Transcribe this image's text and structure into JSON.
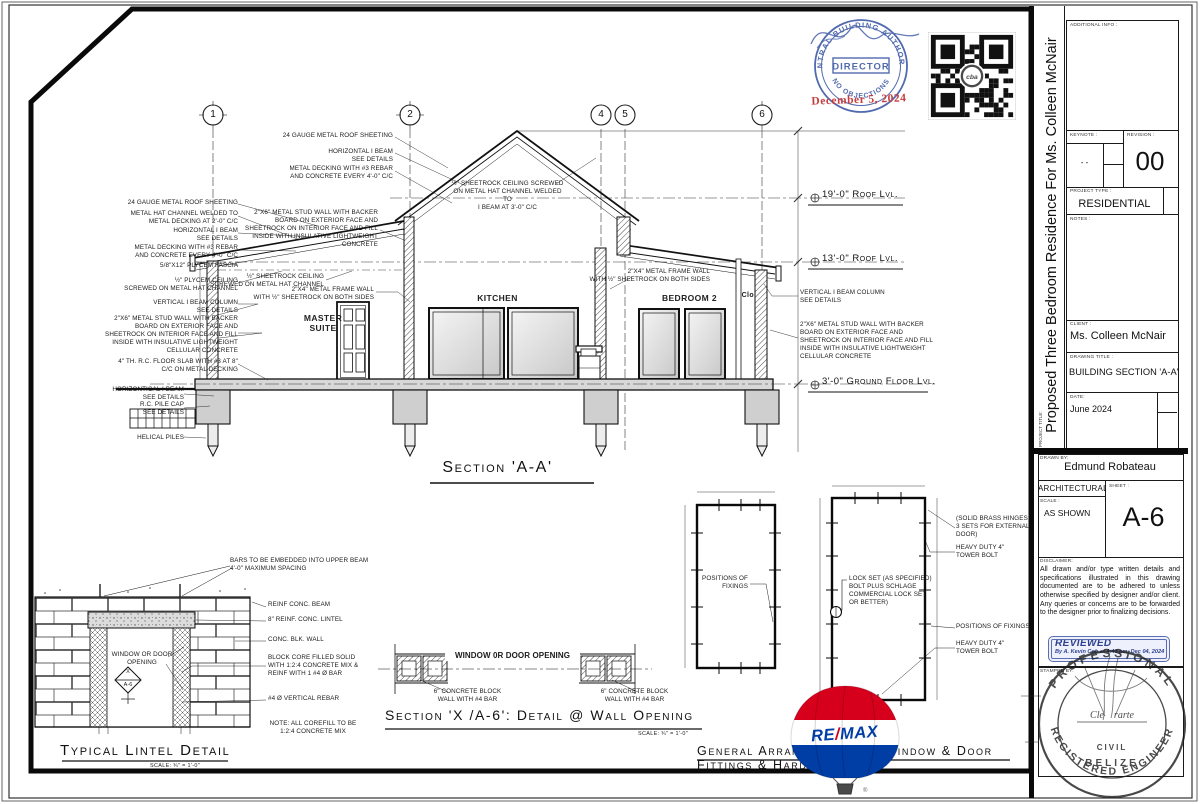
{
  "section": {
    "title": "Section 'A-A'",
    "grids": [
      "1",
      "2",
      "4",
      "5",
      "6"
    ],
    "levels": {
      "roof19": "19'-0\" Roof Lvl.",
      "roof13": "13'-0\" Roof Lvl.",
      "ground": "3'-0\" Ground Floor Lvl."
    },
    "rooms": {
      "master": [
        "MASTER",
        "SUITE"
      ],
      "kitchen": "KITCHEN",
      "bedroom2": "BEDROOM 2",
      "closet": "Clo."
    },
    "ann_left": [
      [
        "24 GAUGE METAL ROOF SHEETING"
      ],
      [
        "METAL HAT CHANNEL WELDED TO",
        "METAL DECKING AT 2'-0\" C/C"
      ],
      [
        "HORIZONTAL I BEAM",
        "SEE DETAILS"
      ],
      [
        "METAL DECKING WITH #3 REBAR",
        "AND CONCRETE EVERY 4'-0\" C/C"
      ],
      [
        "5/8\"X12\" PLYCEM FASCIA"
      ],
      [
        "½\" PLYCEM CEILING",
        "SCREWED ON METAL HAT CHANNEL"
      ],
      [
        "VERTICAL I BEAM COLUMN",
        "SEE DETAILS"
      ],
      [
        "2\"X6\" METAL STUD WALL WITH BACKER",
        "BOARD ON EXTERIOR FACE AND",
        "SHEETROCK ON INTERIOR FACE AND FILL",
        "INSIDE WITH INSULATIVE LIGHTWEIGHT",
        "CELLULAR CONCRETE"
      ],
      [
        "4\" TH. R.C. FLOOR SLAB WITH #3 AT 8\"",
        "C/C ON METAL DECKING"
      ],
      [
        "HORIZONTICAL I BEAM",
        "SEE DETAILS"
      ],
      [
        "R.C.  PILE CAP",
        "SEE DETAILS"
      ],
      [
        "HELICAL PILES"
      ]
    ],
    "ann_top": [
      [
        "24 GAUGE METAL ROOF SHEETING"
      ],
      [
        "HORIZONTAL I BEAM",
        "SEE DETAILS"
      ],
      [
        "METAL DECKING WITH #3 REBAR",
        "AND CONCRETE EVERY 4'-0\" C/C"
      ],
      [
        "2\"X6\" METAL STUD WALL WITH BACKER",
        "BOARD ON EXTERIOR FACE AND",
        "SHEETROCK ON INTERIOR FACE AND FILL",
        "INSIDE WITH INSULATIVE LIGHTWEIGHT",
        "CONCRETE"
      ]
    ],
    "ridge_ceiling": [
      "½\" SHEETROCK CEILING SCREWED",
      "ON METAL HAT CHANNEL WELDED TO",
      "I BEAM AT 3'-0\" C/C"
    ],
    "master_ceiling": [
      "½\" SHEETROCK CEILING",
      "SCREWED ON METAL HAT CHANNEL"
    ],
    "frame_wall_left": [
      "2\"X4\" METAL FRAME WALL",
      "WITH ½\" SHEETROCK ON BOTH SIDES"
    ],
    "frame_wall_right": [
      "2\"X4\" METAL FRAME WALL",
      "WITH ½\" SHEETROCK ON BOTH SIDES"
    ],
    "ann_right": [
      [
        "VERTICAL I BEAM COLUMN",
        "SEE DETAILS"
      ],
      [
        "2\"X6\" METAL STUD WALL WITH BACKER",
        "BOARD ON EXTERIOR FACE AND",
        "SHEETROCK ON INTERIOR FACE AND FILL",
        "INSIDE WITH INSULATIVE LIGHTWEIGHT",
        "CELLULAR CONCRETE"
      ]
    ]
  },
  "lintel": {
    "ann": [
      [
        "BARS TO BE EMBEDDED INTO UPPER BEAM",
        "4'-0\" MAXIMUM SPACING"
      ],
      [
        "REINF CONC. BEAM"
      ],
      [
        "8\" REINF. CONC.  LINTEL"
      ],
      [
        "CONC. BLK. WALL"
      ],
      [
        "BLOCK CORE FILLED SOLID",
        "WITH 1:2:4 CONCRETE MIX &",
        "REINF WITH 1 #4 Ø BAR"
      ],
      [
        "#4 Ø VERTICAL REBAR"
      ],
      [
        "NOTE: ALL COREFILL TO BE",
        "1:2:4 CONCRETE MIX"
      ]
    ],
    "opening": [
      "WINDOW OR DOOR",
      "OPENING"
    ],
    "marker_top": "X",
    "marker_bottom": "A-6",
    "title": "Typical Lintel Detail",
    "scale": "SCALE: ¾\" = 1'-0\""
  },
  "wallopen": {
    "opening": "WINDOW 0R DOOR OPENING",
    "block_left": [
      "6\" CONCRETE BLOCK",
      "WALL WITH #4 BAR"
    ],
    "block_right": [
      "6\" CONCRETE BLOCK",
      "WALL WITH #4 BAR"
    ],
    "title": "Section 'X /A-6': Detail @ Wall Opening",
    "scale": "SCALE: ¾\" = 1'-0\""
  },
  "hardware": {
    "fixings_window": [
      "POSITIONS OF",
      "FIXINGS"
    ],
    "hinges": [
      "(SOLID BRASS HINGES",
      "3 SETS FOR EXTERNAL",
      "DOOR)"
    ],
    "bolt_top": [
      "HEAVY DUTY 4\"",
      "TOWER BOLT"
    ],
    "lockset": [
      "LOCK SET (AS SPECIFIED)",
      "BOLT PLUS SCHLAGE",
      "COMMERCIAL LOCK SET",
      "OR BETTER)"
    ],
    "fixings_door": "POSITIONS OF FIXINGS",
    "bolt_bottom": [
      "HEAVY DUTY 4\"",
      "TOWER BOLT"
    ],
    "title": [
      "General Arrangement For Window & Door",
      "Fittings & Hardware"
    ]
  },
  "titleblock": {
    "additional_info_label": "ADDITIONAL INFO :",
    "keynote_label": "KEYNOTE :",
    "keynote_value": "- -",
    "revision_label": "REVISION :",
    "revision_value": "00",
    "project_type_label": "PROJECT TYPE :",
    "project_type_value": "RESIDENTIAL",
    "notes_label": "NOTES :",
    "client_label": "CLIENT :",
    "client_value": "Ms. Colleen McNair",
    "drawing_title_label": "DRAWING TITLE :",
    "drawing_title_value": "BUILDING SECTION 'A-A'",
    "date_label": "DATE:",
    "date_value": "June 2024",
    "project_title_label": "PROJECT TITLE:",
    "project_title_vertical": "Proposed Three Bedroom Residence For Ms. Colleen McNair",
    "drawn_by_label": "DRAWN BY:",
    "drawn_by_value": "Edmund Robateau",
    "discipline": "ARCHITECTURAL",
    "scale_label": "SCALE :",
    "scale_value": "AS SHOWN",
    "sheet_label": "SHEET :",
    "sheet_value": "A-6",
    "disclaimer_label": "DISCLAIMER:",
    "disclaimer_text": "All drawn and/or type written details and specifications illustrated in this drawing documented are to be adhered to unless otherwise specified by designer and/or client. Any queries or concerns are to be forwarded to the designer prior to finalizing decisions.",
    "reviewed_title": "REVIEWED",
    "reviewed_by": "By A. Kevin Cob at 4:48 pm, Dec 04, 2024",
    "stamped_by_label": "STAMPED BY:"
  },
  "stamps": {
    "cba_authority": "CENTRAL BUILDING AUTHORITY",
    "cba_director": "DIRECTOR",
    "cba_no_objections": "NO OBJECTIONS",
    "cba_date": "December 5, 2024",
    "qr_center": "cba",
    "remax_re": "RE",
    "remax_slash": "/",
    "remax_max": "MAX",
    "registered_mark": "®",
    "professional_arc_top": "PROFESSIONAL",
    "professional_arc_bottom": "REGISTERED  ENGINEER",
    "professional_name": "Cle    rarte",
    "professional_field": "CIVIL",
    "professional_country": "BELIZE"
  }
}
